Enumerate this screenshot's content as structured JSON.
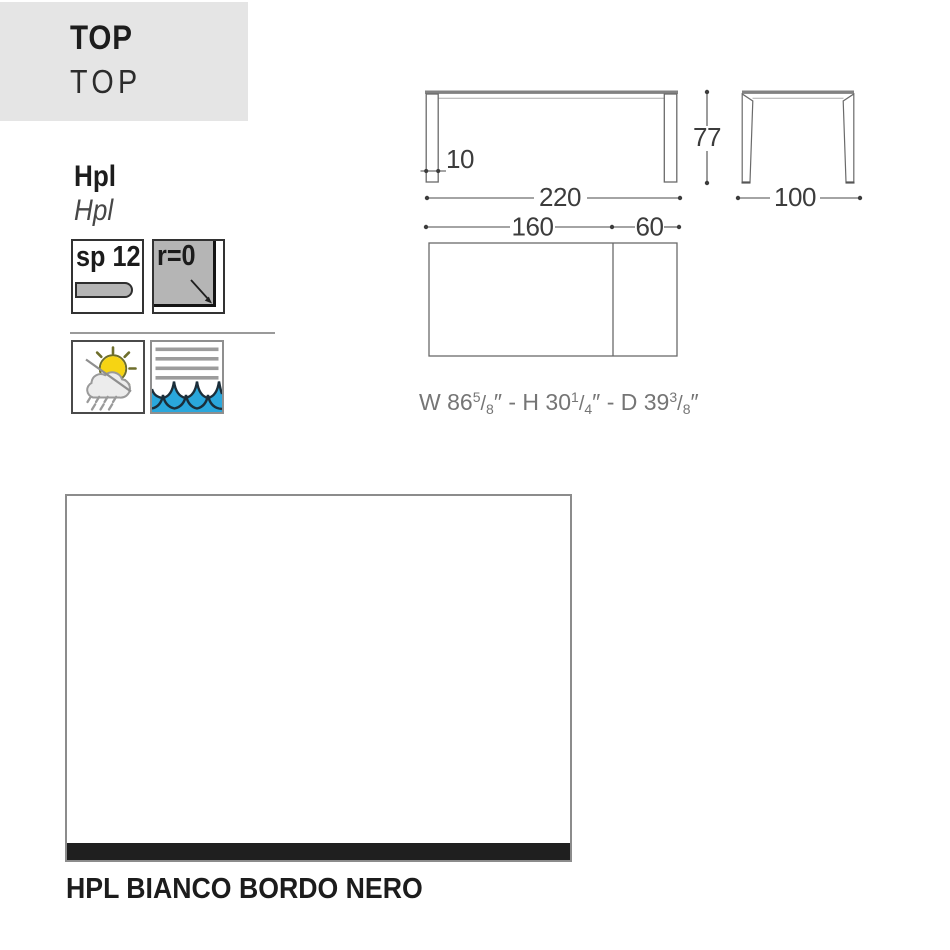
{
  "header": {
    "title": "TOP",
    "subtitle": "TOP"
  },
  "material": {
    "name_bold": "Hpl",
    "name_italic": "Hpl"
  },
  "specs": {
    "thickness_label": "sp 12",
    "radius_label": "r=0"
  },
  "icons": {
    "thickness": "sheet-thickness-icon",
    "radius": "corner-radius-icon",
    "weather": "sun-cloud-rain-icon",
    "water": "water-waves-icon"
  },
  "drawing": {
    "front_width": "220",
    "front_height": "77",
    "leg_thickness": "10",
    "side_depth": "100",
    "top_fixed": "160",
    "top_extension": "60"
  },
  "imperial": {
    "w_prefix": "W 86",
    "w_num": "5",
    "w_slash": "/",
    "w_den": "8",
    "h_prefix": "″ - H 30",
    "h_num": "1",
    "h_slash": "/",
    "h_den": "4",
    "d_prefix": "″ - D 39",
    "d_num": "3",
    "d_slash": "/",
    "d_den": "8",
    "suffix": "″"
  },
  "finish": {
    "label": "HPL BIANCO BORDO NERO"
  },
  "colors": {
    "header_gray": "#e5e5e5",
    "fill_gray": "#b5b5b5",
    "water_blue": "#2aa7dc",
    "sun_yellow": "#f6d413",
    "edge_black": "#1f1f1f"
  }
}
